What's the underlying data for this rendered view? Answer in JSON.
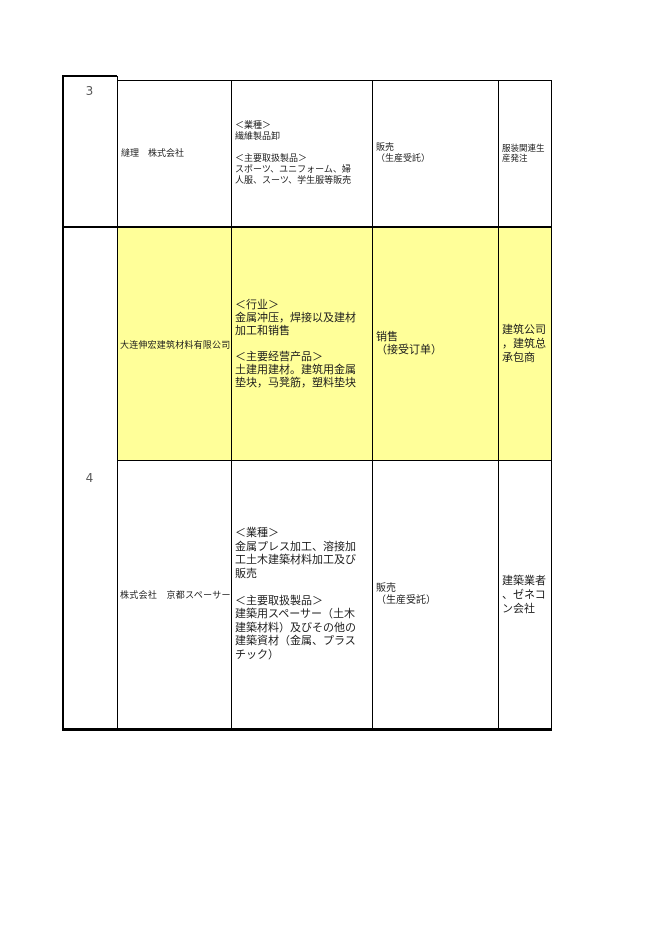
{
  "document": {
    "kind": "company-list-table",
    "language": "japanese-chinese"
  },
  "colors": {
    "highlight_fill": "#ffff99",
    "grid_line": "#000000",
    "row_number_text": "#5a5a5a"
  },
  "table": {
    "rows": [
      {
        "number": "3",
        "entries": [
          {
            "highlighted": false,
            "company": "縫理　株式会社",
            "business": "＜業種＞\n繊維製品卸\n\n＜主要取扱製品＞\nスポーツ、ユニフォーム、婦\n人服、スーツ、学生服等販売",
            "sales": "販売\n（生産受託）",
            "note": "服装関連生\n産発注"
          }
        ]
      },
      {
        "number": "4",
        "entries": [
          {
            "highlighted": true,
            "company": "大连伸宏建筑材料有限公司",
            "business": "＜行业＞\n金属冲压，焊接以及建材\n加工和销售\n\n＜主要经营产品＞\n土建用建材。建筑用金属\n垫块，马凳筋，塑料垫块",
            "sales": "销售\n（接受订单）",
            "note": "建筑公司\n，建筑总\n承包商"
          },
          {
            "highlighted": false,
            "company": "株式会社　京都スペーサー",
            "business": "＜業種＞\n金属プレス加工、溶接加\n工土木建築材料加工及び\n販売\n\n＜主要取扱製品＞\n建築用スペーサー（土木\n建築材料）及びその他の\n建築資材（金属、プラス\nチック）",
            "sales": "販売\n（生産受託）",
            "note": "建築業者\n、ゼネコ\nン会社"
          }
        ]
      }
    ]
  }
}
